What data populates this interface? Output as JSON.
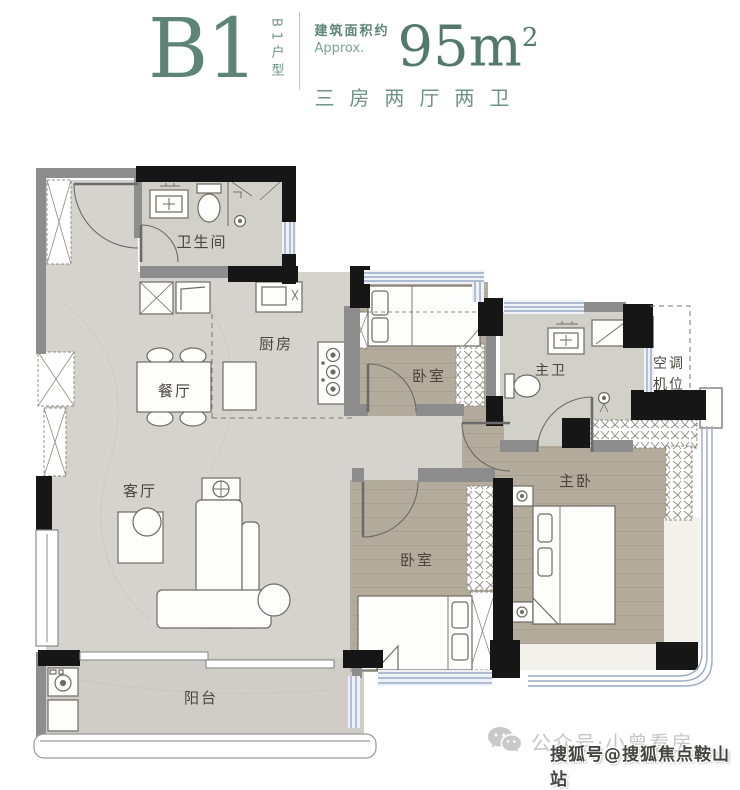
{
  "header": {
    "unit": "B1",
    "unit_type_vertical": "B1户型",
    "area_label_cn": "建筑面积约",
    "area_label_en": "Approx.",
    "area_value": "95m",
    "area_sup": "2",
    "layout": "三房两厅两卫"
  },
  "rooms": [
    {
      "id": "bathroom",
      "label": "卫生间"
    },
    {
      "id": "kitchen",
      "label": "厨房"
    },
    {
      "id": "dining",
      "label": "餐厅"
    },
    {
      "id": "living",
      "label": "客厅"
    },
    {
      "id": "balcony",
      "label": "阳台"
    },
    {
      "id": "bedroom-top",
      "label": "卧室"
    },
    {
      "id": "master-bath",
      "label": "主卫"
    },
    {
      "id": "master-bedroom",
      "label": "主卧"
    },
    {
      "id": "bedroom-bottom",
      "label": "卧室"
    }
  ],
  "ac_bay": {
    "line1": "空调",
    "line2": "机位"
  },
  "watermarks": {
    "wechat_account": "公众号·小曾看房",
    "sohu_account": "搜狐号@搜狐焦点鞍山站"
  },
  "colors": {
    "accent_green": "#5d8475",
    "wall_black": "#161616",
    "wall_gray": "#8d8d8d",
    "floor_marble": "#d6d3ce",
    "floor_wood": "#b3ab9b",
    "floor_tile": "#d2d1c9",
    "window_blue": "#9aa9c7"
  }
}
